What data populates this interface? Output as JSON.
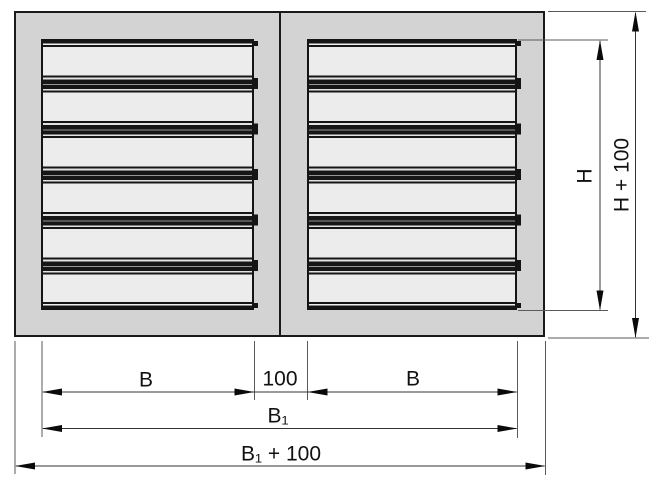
{
  "drawing": {
    "labels": {
      "b_left": "B",
      "gap": "100",
      "b_right": "B",
      "b1": "B₁",
      "b1_plus_100": "B₁ + 100",
      "h": "H",
      "h_plus_100": "H + 100"
    },
    "colors": {
      "plate_fill": "#d3d3d3",
      "panel_fill": "#ececec",
      "outline": "#1a1a1a",
      "dimension_line": "#333333",
      "background": "#ffffff"
    },
    "panels": 2,
    "louver_blades_per_panel": 6
  }
}
